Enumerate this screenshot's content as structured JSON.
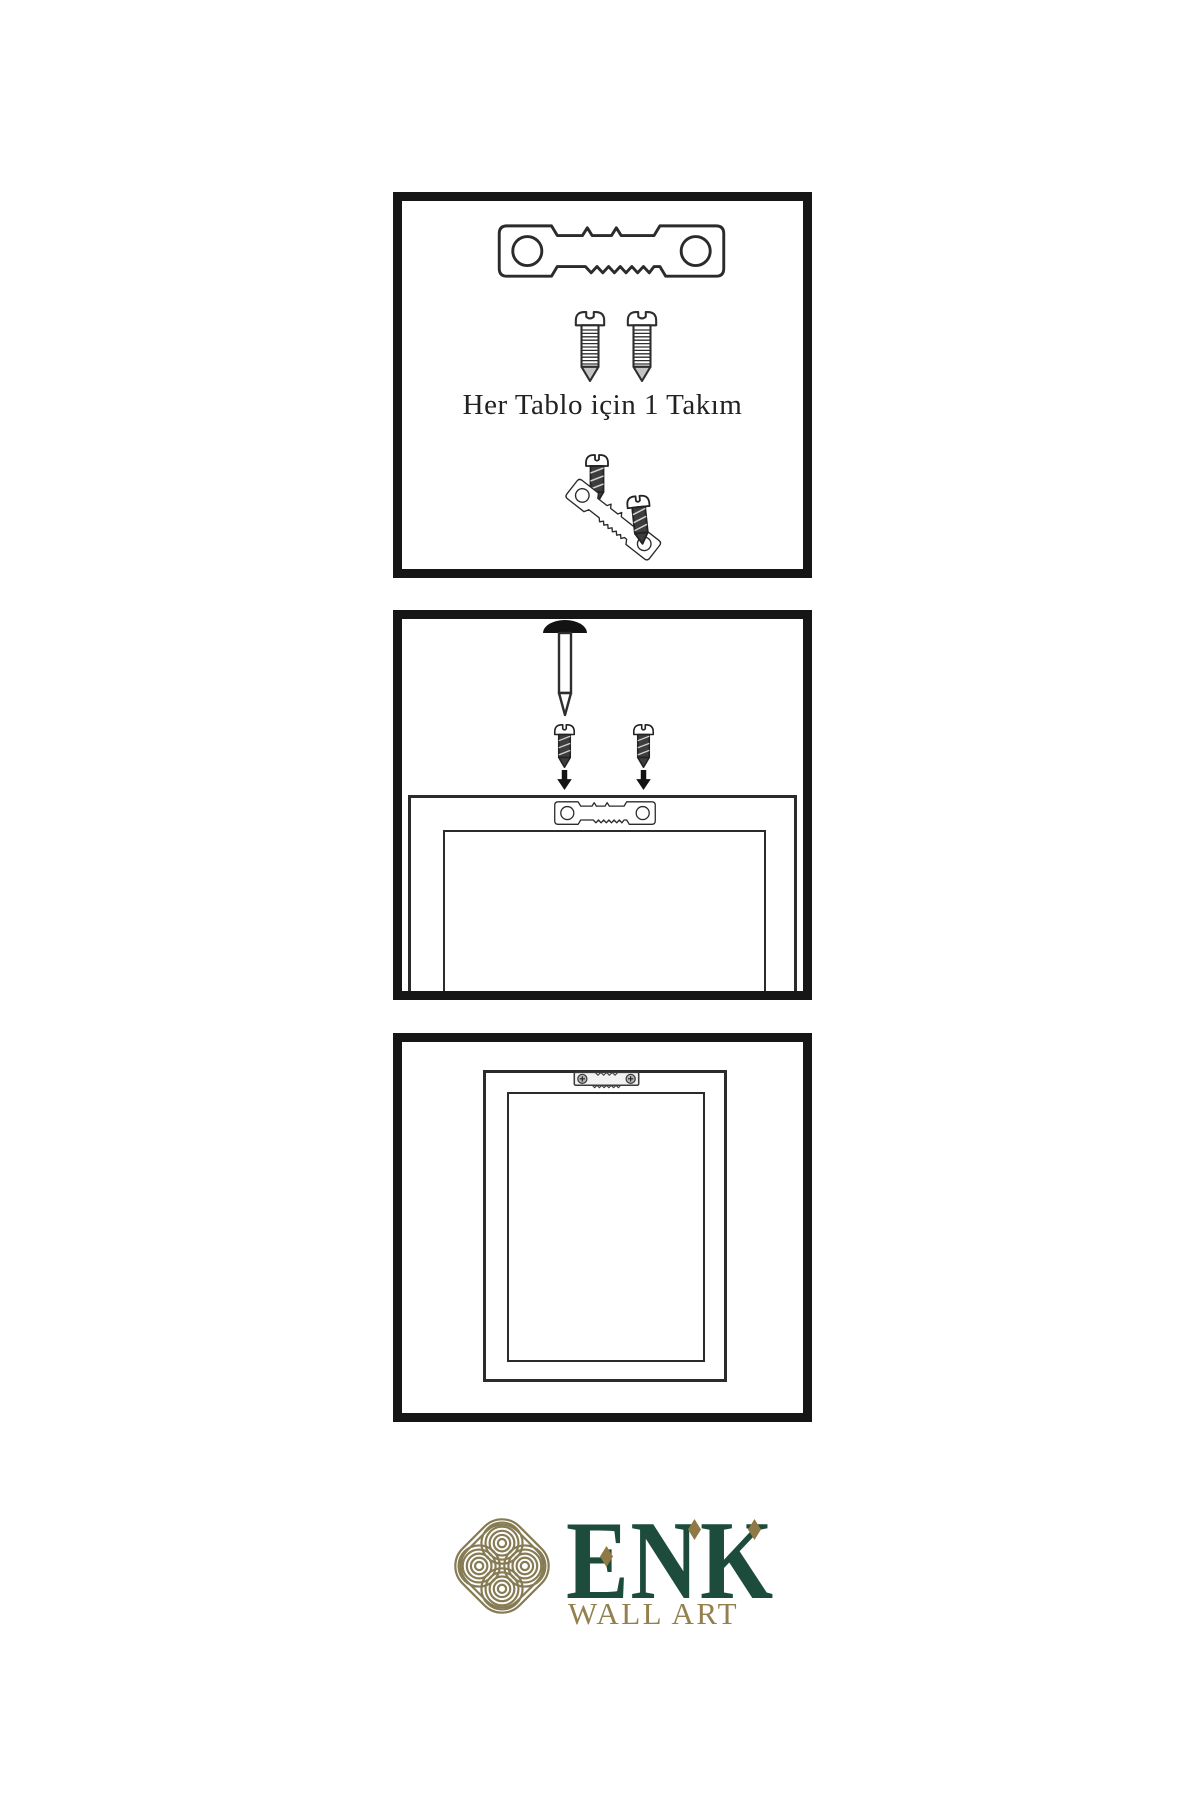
{
  "panels": {
    "panel1": {
      "caption": "Her Tablo için 1 Takım"
    },
    "panel2": {
      "caption": ""
    },
    "panel3": {
      "caption": ""
    }
  },
  "logo": {
    "brand": "ENK",
    "subtitle": "WALL ART"
  },
  "colors": {
    "background": "#ffffff",
    "panel_border": "#161616",
    "line_art": "#2b2b2b",
    "dark_fill": "#3d3d3d",
    "brand_green": "#1d4b3c",
    "brand_gold": "#8f7a45",
    "knot_gold": "#867b52"
  },
  "icons": {
    "sawtooth_hanger": "sawtooth-hanger-icon",
    "screw_light": "screw-icon",
    "screw_dark": "dark-screw-icon",
    "wall_nail": "nail-icon",
    "down_arrow": "arrow-down-icon",
    "hanger_mounted": "mounted-hanger-icon",
    "knot_logo": "knot-logo-icon"
  }
}
